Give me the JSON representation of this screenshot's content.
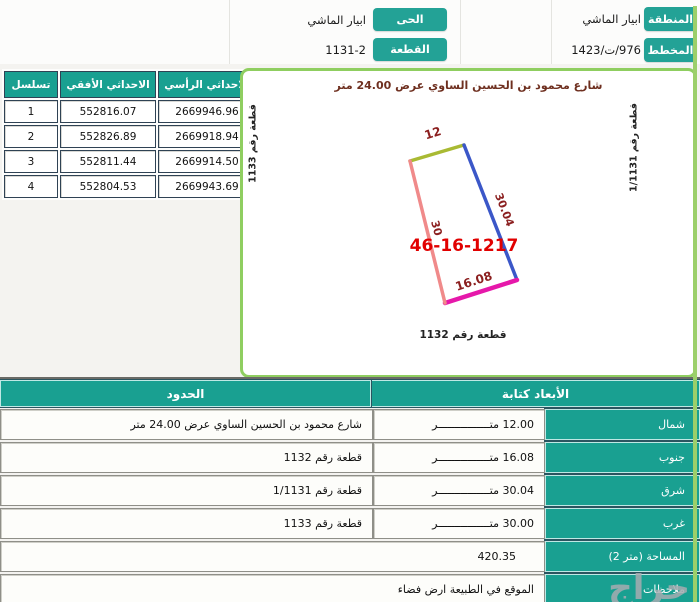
{
  "colors": {
    "teal": "#19a091",
    "button_teal": "#23a296",
    "panel_border_green": "#8fce60",
    "edge_top": "#a9ba33",
    "edge_right": "#3b57c8",
    "edge_bottom": "#e618aa",
    "edge_left": "#f08a8a",
    "dim_label": "#8b1f1f",
    "parcel_number_red": "#e10000",
    "street_text": "#6e2f1f"
  },
  "top": {
    "region_label": "المنطقة",
    "region_value": "ابيار الماشي",
    "plan_label": "المخطط",
    "plan_value": "976/ت/1423",
    "district_label": "الحى",
    "district_value": "ابيار الماشي",
    "parcel_label": "القطعة",
    "parcel_value": "1131-2"
  },
  "coords_table": {
    "headers": {
      "serial": "تسلسل",
      "x": "الاحداثي الأفقي",
      "y": "الاحداثي الرأسي"
    },
    "rows": [
      {
        "serial": "1",
        "x": "552816.07",
        "y": "2669946.96"
      },
      {
        "serial": "2",
        "x": "552826.89",
        "y": "2669918.94"
      },
      {
        "serial": "3",
        "x": "552811.44",
        "y": "2669914.50"
      },
      {
        "serial": "4",
        "x": "552804.53",
        "y": "2669943.69"
      }
    ]
  },
  "plot": {
    "street_label": "شارع محمود بن الحسين الساوي عرض 24.00 متر",
    "left_label": "قطعة رقم 1133",
    "right_label": "قطعة رقم 1/1131",
    "bottom_label": "قطعة رقم 1132",
    "parcel_number": "46-16-1217",
    "dim_top": "12",
    "dim_right": "30.04",
    "dim_left": "30",
    "dim_bottom": "16.08"
  },
  "bounds_table": {
    "header_bounds": "الحدود",
    "header_dims": "الأبعاد كتابة",
    "rows": [
      {
        "label": "شمال",
        "dim": "12.00 متــــــــــــــــر",
        "bound": "شارع محمود بن الحسين الساوي عرض 24.00 متر"
      },
      {
        "label": "جنوب",
        "dim": "16.08 متــــــــــــــــر",
        "bound": "قطعة رقم 1132"
      },
      {
        "label": "شرق",
        "dim": "30.04 متــــــــــــــــر",
        "bound": "قطعة رقم 1/1131"
      },
      {
        "label": "غرب",
        "dim": "30.00 متــــــــــــــــر",
        "bound": "قطعة رقم 1133"
      }
    ],
    "area_label": "المساحة (متر 2)",
    "area_value": "420.35",
    "notes_label": "ملاحظات",
    "notes_value": "الموقع في الطبيعة ارض فضاء"
  },
  "watermark": "حراج"
}
